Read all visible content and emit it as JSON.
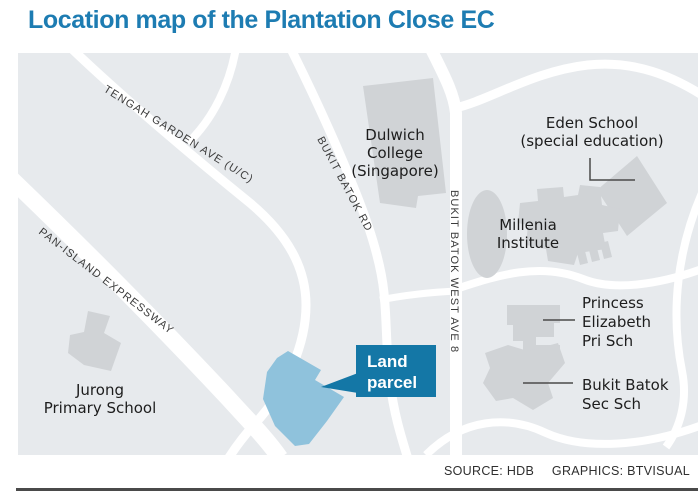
{
  "title": "Location map of the Plantation Close EC",
  "map": {
    "road_labels": {
      "tengah": "TENGAH GARDEN AVE (U/C)",
      "pie": "PAN-ISLAND EXPRESSWAY",
      "bukit_batok_rd": "BUKIT BATOK RD",
      "bukit_batok_west": "BUKIT BATOK WEST AVE 8"
    },
    "places": {
      "dulwich": {
        "line1": "Dulwich",
        "line2": "College",
        "line3": "(Singapore)"
      },
      "eden": {
        "line1": "Eden School",
        "line2": "(special education)"
      },
      "millenia": {
        "line1": "Millenia",
        "line2": "Institute"
      },
      "princess": {
        "line1": "Princess",
        "line2": "Elizabeth",
        "line3": "Pri Sch"
      },
      "bukit_batok_sec": {
        "line1": "Bukit Batok",
        "line2": "Sec Sch"
      },
      "jurong": {
        "line1": "Jurong",
        "line2": "Primary School"
      }
    },
    "land_parcel": {
      "line1": "Land",
      "line2": "parcel"
    }
  },
  "footer": {
    "source": "SOURCE: HDB",
    "graphics": "GRAPHICS: BTVISUAL"
  },
  "colors": {
    "title": "#1d7cb2",
    "map_background": "#e7eaed",
    "road": "#ffffff",
    "building": "#d0d3d6",
    "land_parcel": "#8fc2dc",
    "callout_box": "#1477a6",
    "label_text": "#1d1d1d",
    "bottom_rule": "#4a4a4a"
  }
}
